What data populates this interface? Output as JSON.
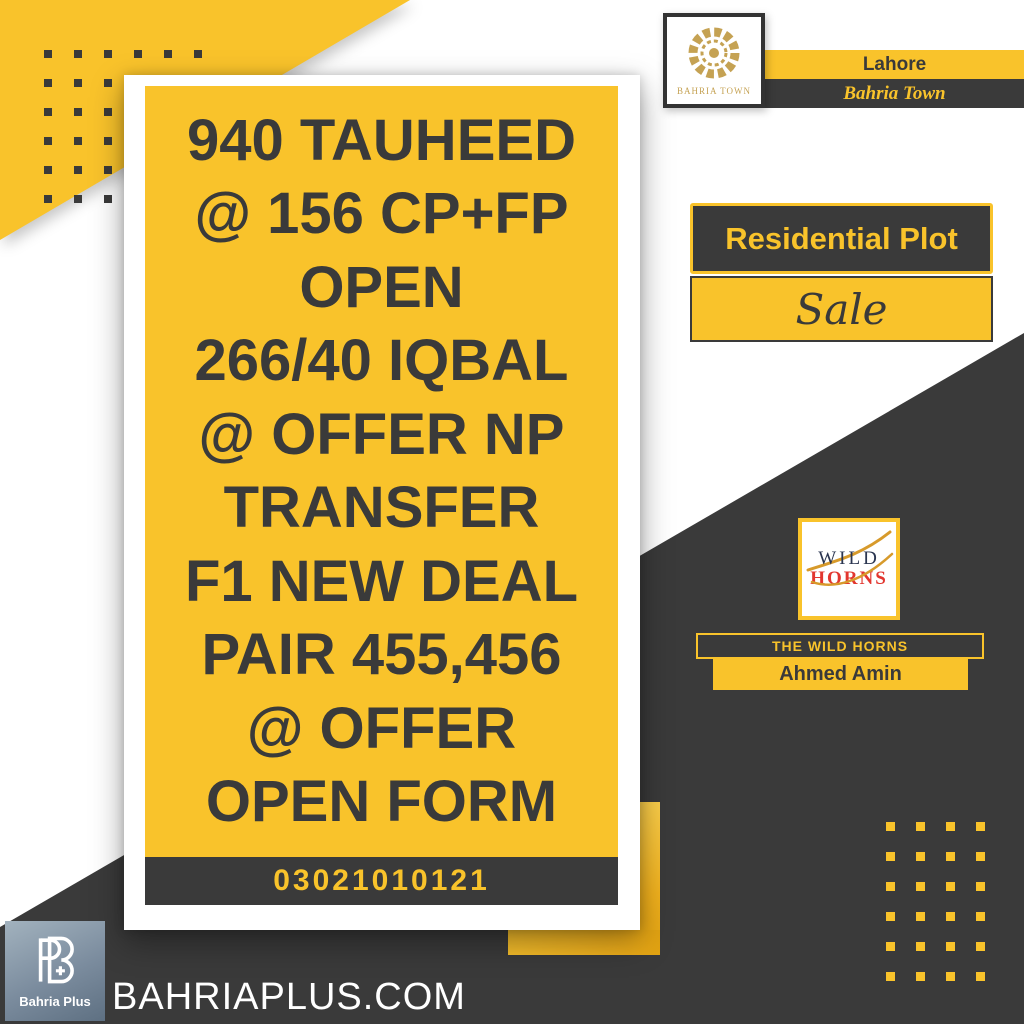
{
  "header": {
    "logo_caption": "BAHRIA TOWN",
    "city": "Lahore",
    "brand": "Bahria Town"
  },
  "listing": {
    "category": "Residential Plot",
    "deal_type": "Sale",
    "lines": [
      "940 TAUHEED",
      "@ 156 CP+FP",
      "OPEN",
      "266/40 IQBAL",
      "@ OFFER NP",
      "TRANSFER",
      "F1 NEW DEAL",
      "PAIR 455,456",
      "@ OFFER",
      "OPEN FORM"
    ],
    "phone": "03021010121"
  },
  "agency": {
    "logo_word_1": "WILD",
    "logo_word_2": "HORNS",
    "name": "THE WILD HORNS",
    "agent": "Ahmed Amin"
  },
  "footer": {
    "publisher": "Bahria Plus",
    "website": "BAHRIAPLUS.COM"
  },
  "colors": {
    "yellow": "#F9C32B",
    "charcoal": "#3A3A3A",
    "gold": "#C5A253",
    "logo_red": "#E2362F",
    "logo_navy": "#2A3550",
    "plus_logo_gray": "#7B8C9E"
  }
}
